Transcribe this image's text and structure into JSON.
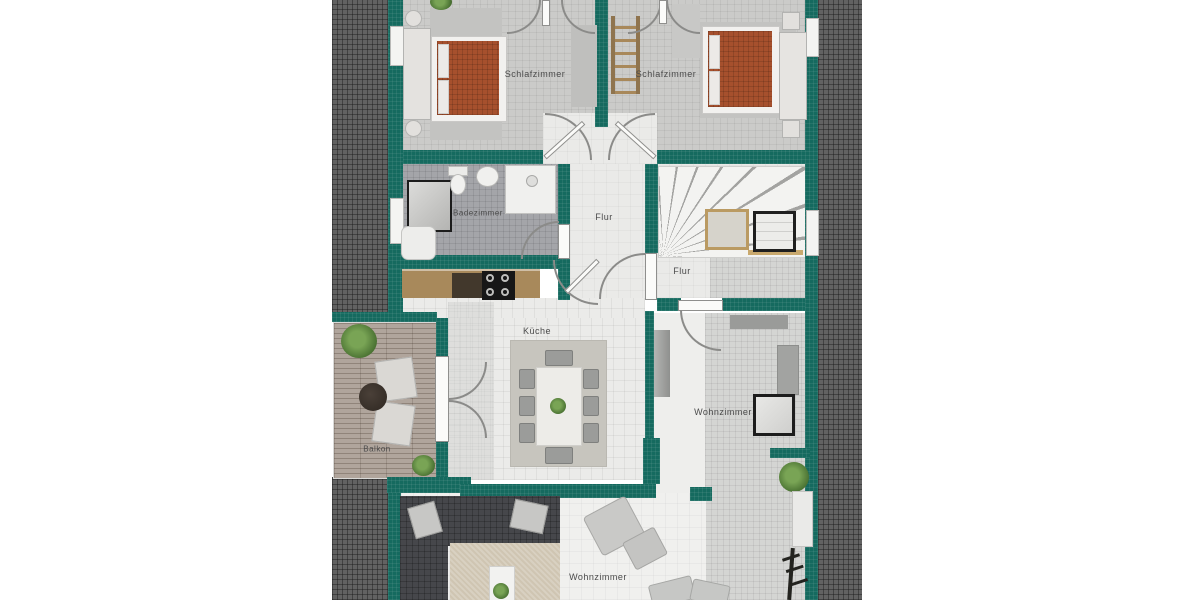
{
  "rooms": {
    "bedroom_left": {
      "label": "Schlafzimmer"
    },
    "bedroom_right": {
      "label": "Schlafzimmer"
    },
    "bathroom": {
      "label": "Badezimmer"
    },
    "hallway": {
      "label": "Flur"
    },
    "hallway_stairs": {
      "label": "Flur"
    },
    "kitchen": {
      "label": "Küche"
    },
    "balcony": {
      "label": "Balkon"
    },
    "living_room_right": {
      "label": "Wohnzimmer"
    },
    "living_room_main": {
      "label": "Wohnzimmer"
    }
  },
  "colors": {
    "wall_teal": "#156a5f",
    "roof_hatch": "#626262",
    "bedroom_carpet": "#cbcbc9",
    "bathroom_tile": "#a4a5a9",
    "kitchen_floor": "#ebebe9",
    "hall_floor": "#eaeae8",
    "terrace_tile": "#d4d5d3",
    "balcony_deck": "#b0a59c",
    "bed_cover": "#a6502d",
    "sofa_dark": "#46474b",
    "rug_beige": "#cfc5b2",
    "counter_wood": "#a8895b",
    "stair_wood_frame": "#ba9a62",
    "label_text": "#4b4b4b"
  }
}
